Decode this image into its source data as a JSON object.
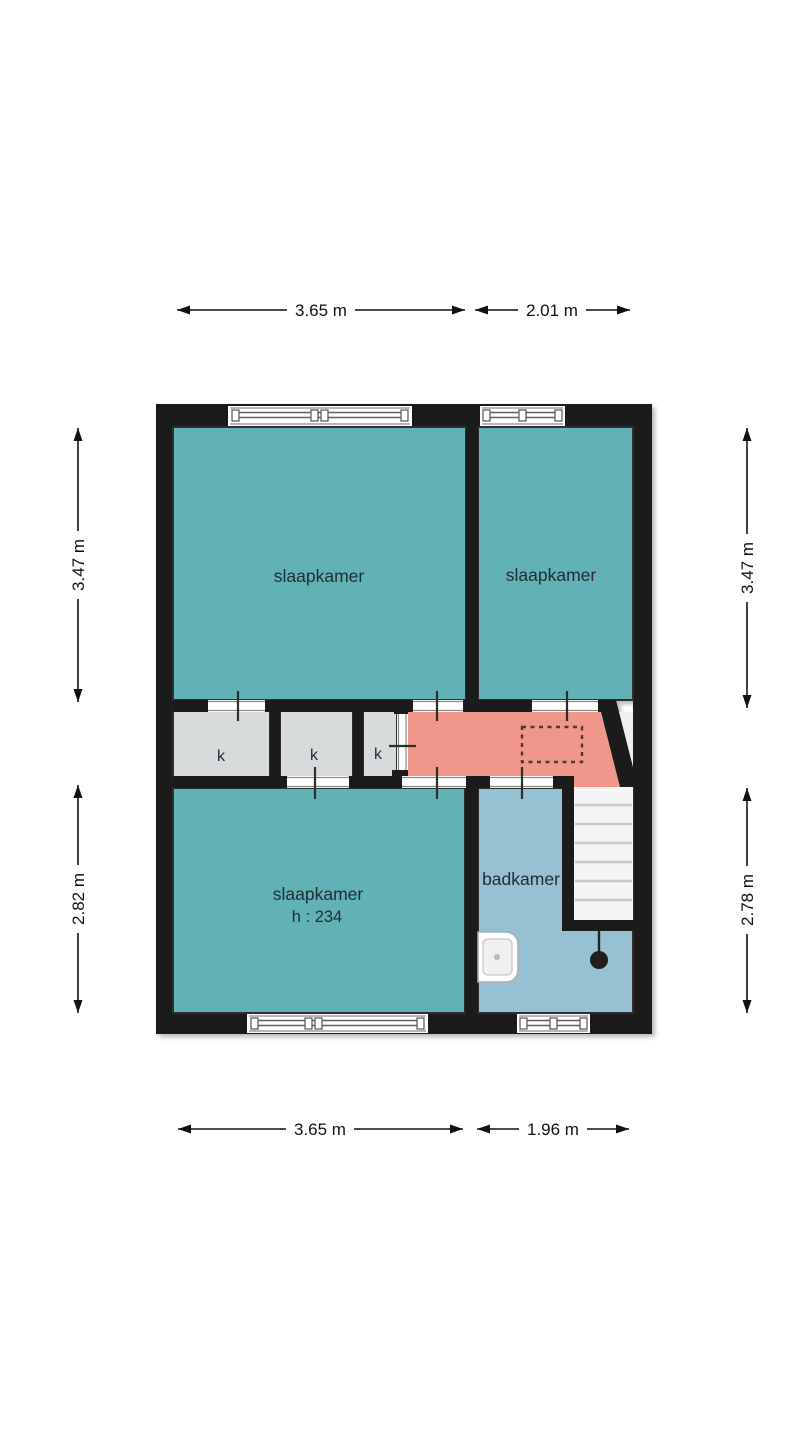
{
  "plan": {
    "type": "floorplan-upper-floor",
    "rooms": {
      "bedroom_top_left": {
        "label": "slaapkamer"
      },
      "bedroom_top_right": {
        "label": "slaapkamer"
      },
      "bedroom_bottom": {
        "label": "slaapkamer",
        "height_note": "h : 234"
      },
      "bathroom": {
        "label": "badkamer"
      },
      "closet_1": {
        "label": "k"
      },
      "closet_2": {
        "label": "k"
      },
      "closet_3": {
        "label": "k"
      }
    },
    "dimensions": {
      "top_left_width": "3.65 m",
      "top_right_width": "2.01 m",
      "bottom_left_width": "3.65 m",
      "bottom_right_width": "1.96 m",
      "left_upper_height": "3.47 m",
      "left_lower_height": "2.82 m",
      "right_upper_height": "3.47 m",
      "right_lower_height": "2.78 m"
    },
    "colors": {
      "room_teal": "#62b1b5",
      "hallway_salmon": "#f0968a",
      "bathroom_blue": "#97c0d2",
      "closet_gray": "#d8dbdc",
      "wall_black": "#1b1b1b",
      "stairs_white": "#f5f5f5",
      "void_white": "#efefef"
    }
  }
}
